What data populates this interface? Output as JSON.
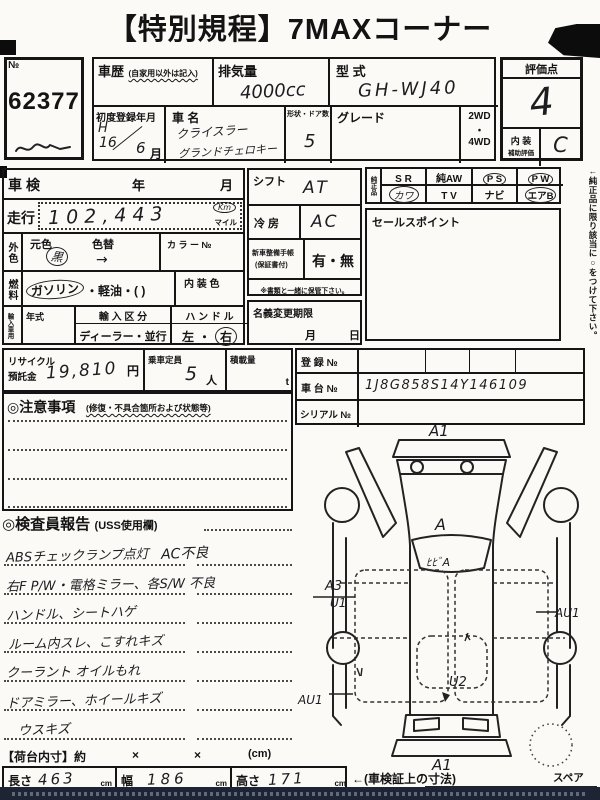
{
  "title": "【特別規程】7MAXコーナー",
  "no_box": {
    "label": "№",
    "value": "62377"
  },
  "top": {
    "shareki_label": "車歴",
    "shareki_note": "(自家用以外は記入)",
    "haiki_label": "排気量",
    "haiki_value": "4000cc",
    "katashiki_label": "型 式",
    "katashiki_value": "GH-WJ40",
    "reg_label": "初度登録年月",
    "reg_era": "H",
    "reg_year": "16",
    "reg_slash": "／",
    "reg_month_value": "6",
    "reg_month_label": "月",
    "name_label": "車 名",
    "name_line1": "クライスラー",
    "name_line2": "グランドチェロキー",
    "doors_label": "形状・ドア数",
    "doors_value": "5",
    "grade_label": "グレード",
    "wd2": "2WD",
    "wd_dot": "・",
    "wd4": "4WD"
  },
  "rating": {
    "label": "評価点",
    "value": "4",
    "interior_label": "内 装",
    "interior_sub": "補助評価",
    "interior_value": "C"
  },
  "left": {
    "shaken": "車検",
    "year": "年",
    "month": "月",
    "soko": "走行",
    "odo": "102,443",
    "km": "Km",
    "mile": "マイル",
    "gaishoku": "外色",
    "motoiro": "元色",
    "motoiro_value": "黒",
    "iroga": "色替",
    "arrow": "→",
    "color_no": "カ ラ ー №",
    "nenryo": "燃料",
    "fuel_gas": "ガソリン",
    "fuel_rest": "・軽油・(      )",
    "naiso": "内 装 色",
    "yunyu": "輸入車用",
    "nenshiki": "年式",
    "kubun": "輸 入 区 分",
    "kubun_value": "ディーラー・並行",
    "handle": "ハ ン ド ル",
    "handle_left": "左",
    "handle_dot": "・",
    "handle_right": "右"
  },
  "mid": {
    "shift_label": "シフト",
    "shift_value": "AT",
    "ac_label": "冷 房",
    "ac_value": "AC",
    "techo_l1": "新車整備手帳",
    "techo_l2": "(保証書付)",
    "techo_value": "有・無",
    "keep_note": "※書類と一緒に保管下さい。",
    "meigi": "名義変更期限",
    "meigi_month": "月",
    "meigi_day": "日"
  },
  "junsei": {
    "label": "純正品",
    "r1c1": "S R",
    "r1c2": "純AW",
    "r1c3": "P S",
    "r1c4": "P W",
    "r2c1": "カワ",
    "r2c2": "T V",
    "r2c3": "ナビ",
    "r2c4": "エアB",
    "side_note": "←純正品に限り該当に○をつけて下さい。",
    "sales": "セールスポイント"
  },
  "recycle": {
    "l1": "リサイクル",
    "l2": "預託金",
    "value": "19,810",
    "yen": "円",
    "teiin": "乗車定員",
    "teiin_value": "5",
    "nin": "人",
    "sekisai": "積載量",
    "ton": "t"
  },
  "reg": {
    "toroku": "登 録 №",
    "shadai": "車 台 №",
    "shadai_value": "1J8G858S14Y146109",
    "serial": "シリアル №"
  },
  "chui": {
    "title": "◎注意事項",
    "note": "(修復・不具合箇所および状態等)"
  },
  "inspector": {
    "title": "◎検査員報告",
    "note": "(USS使用欄)",
    "lines": [
      {
        "left": "ABSチェックランプ点灯",
        "right": "AC不良"
      },
      {
        "left": "右F P/W・電格ミラー、各S/W 不良",
        "right": ""
      },
      {
        "left": "ハンドル、シートハゲ",
        "right": ""
      },
      {
        "left": "ルーム内スレ、こすれキズ",
        "right": ""
      },
      {
        "left": "クーラント オイルもれ",
        "right": ""
      },
      {
        "left": "ドアミラー、ホイールキズ",
        "right": ""
      },
      {
        "left": "ウスキズ",
        "right": ""
      }
    ]
  },
  "diagram": {
    "front_bumper": "A1",
    "hood": "A",
    "windshield": "ﾋﾋﾞA",
    "left_front_door": "A3",
    "left_front_door2": "U1",
    "left_rear": "AU1",
    "right_side": "AU1",
    "rear_gate": "U2",
    "rear_bumper": "A1",
    "spare": "スペア"
  },
  "footer": {
    "nidai": "【荷台内寸】約",
    "x1": "×",
    "x2": "×",
    "cm": "(cm)",
    "len": "長さ",
    "len_value": "463",
    "len_unit": "cm",
    "wid": "幅",
    "wid_value": "186",
    "wid_unit": "cm",
    "hgt": "高さ",
    "hgt_value": "171",
    "hgt_unit": "cm",
    "note": "←(車検証上の寸法)"
  }
}
